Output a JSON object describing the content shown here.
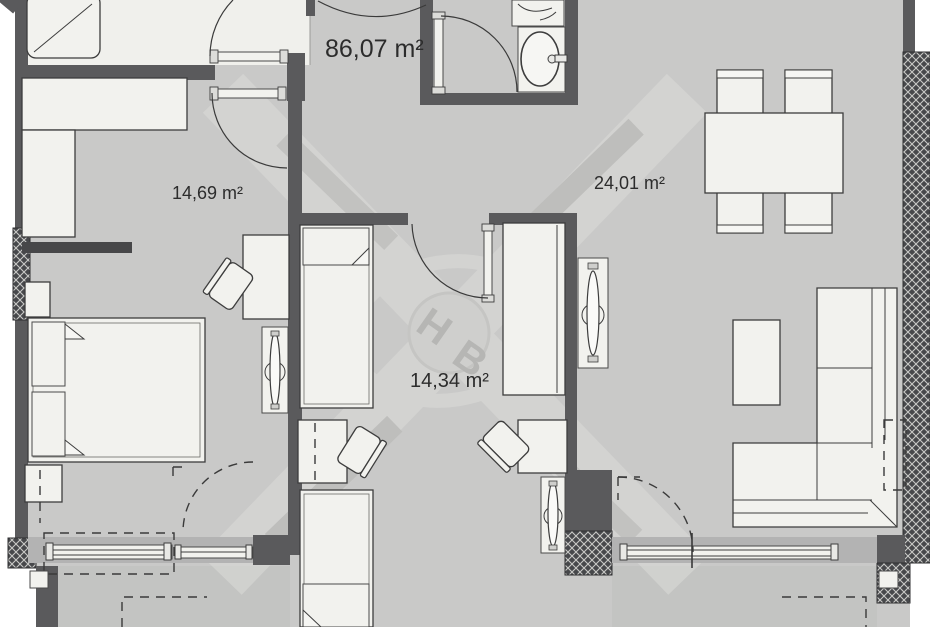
{
  "floorplan": {
    "total_area_label": "86,07 m²",
    "rooms": {
      "bedroom_left": {
        "area_label": "14,69 m²"
      },
      "living_dining": {
        "area_label": "24,01 m²"
      },
      "bedroom_center": {
        "area_label": "14,34 m²"
      }
    },
    "watermark": {
      "letter_1": "H",
      "letter_2": "B"
    },
    "colors": {
      "wall": "#5a5a5c",
      "floor": "#c9c9c8",
      "room_floor_light": "#f0f0ec",
      "furniture": "#f2f2ee",
      "outline": "#3d3d3d",
      "balcony_floor": "#c3c4c2",
      "window_band": "#b3b3b3",
      "label_text": "#2c2c2c",
      "watermark_light": "#dededb"
    }
  }
}
